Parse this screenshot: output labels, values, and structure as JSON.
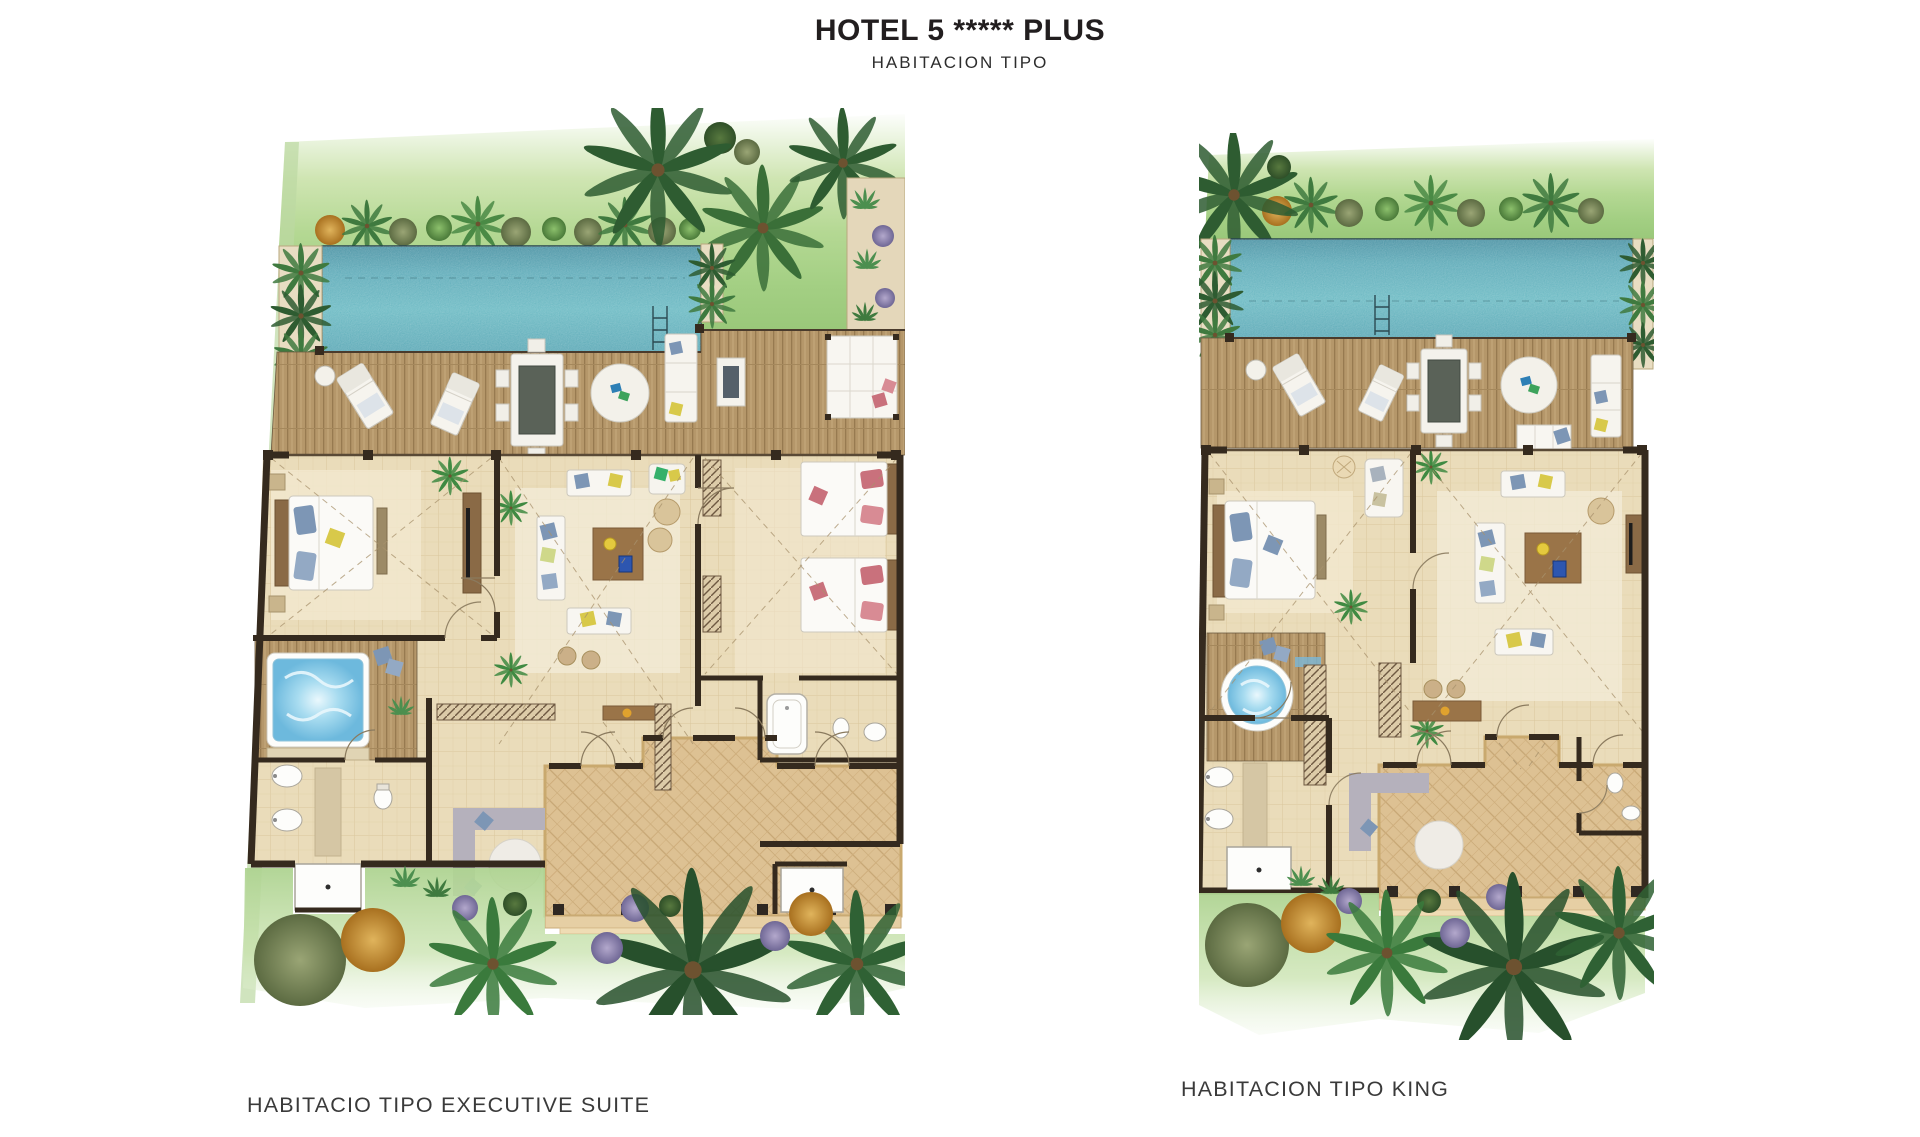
{
  "header": {
    "title": "HOTEL 5 ***** PLUS",
    "subtitle": "HABITACION TIPO"
  },
  "plans": [
    {
      "id": "executive-suite",
      "caption": "HABITACIO TIPO EXECUTIVE SUITE"
    },
    {
      "id": "king",
      "caption": "HABITACION TIPO KING"
    }
  ],
  "palette": {
    "pool": "#4fa5b2",
    "pool_shallow": "#86cbd1",
    "deck_wood": "#b5976a",
    "garden_green": "#a7d18a",
    "interior_floor": "#eadcba",
    "courtyard_sand": "#ddc193",
    "wall_dark": "#352a1e",
    "jacuzzi_blue": "#8ccfe9",
    "accent_pillow_blue": "#7d96b5",
    "accent_pillow_pink": "#c9717c",
    "accent_pillow_yellow": "#d8c94a"
  }
}
